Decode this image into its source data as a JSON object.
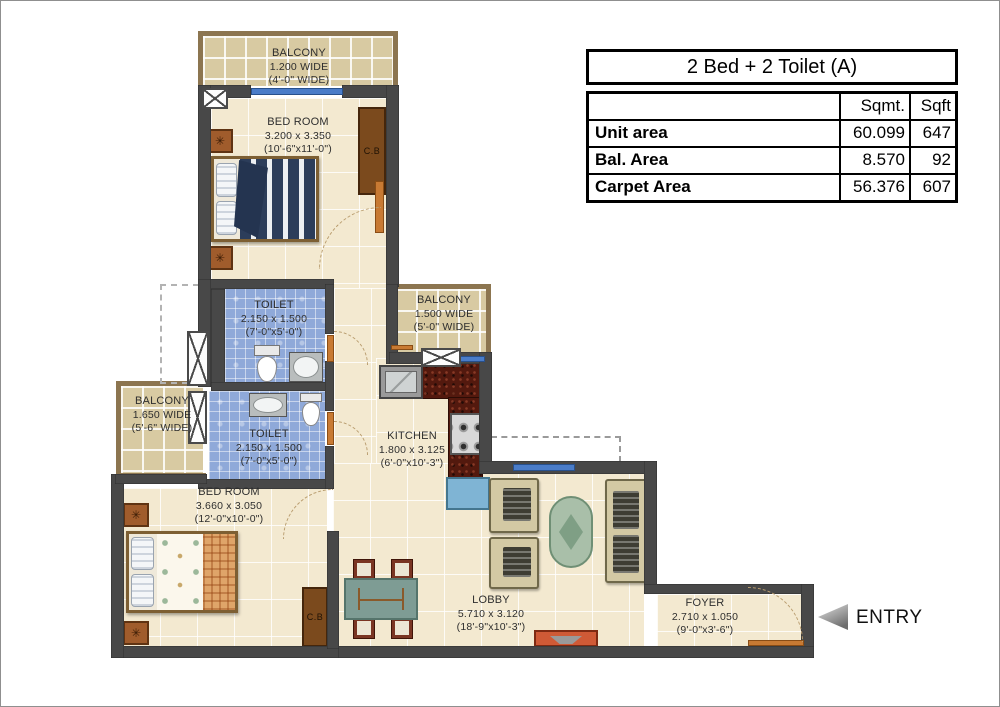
{
  "table": {
    "title": "2 Bed + 2 Toilet (A)",
    "columns": [
      "",
      "Sqmt.",
      "Sqft"
    ],
    "rows": [
      {
        "label": "Unit area",
        "sqmt": "60.099",
        "sqft": "647"
      },
      {
        "label": "Bal. Area",
        "sqmt": "8.570",
        "sqft": "92"
      },
      {
        "label": "Carpet Area",
        "sqmt": "56.376",
        "sqft": "607"
      }
    ]
  },
  "rooms": {
    "balcony_top": {
      "name": "BALCONY",
      "dim_m": "1.200 WIDE",
      "dim_ft": "(4'-0\" WIDE)"
    },
    "bedroom_top": {
      "name": "BED ROOM",
      "dim_m": "3.200 x 3.350",
      "dim_ft": "(10'-6\"x11'-0\")"
    },
    "toilet_top": {
      "name": "TOILET",
      "dim_m": "2.150 x 1.500",
      "dim_ft": "(7'-0\"x5'-0\")"
    },
    "balcony_right": {
      "name": "BALCONY",
      "dim_m": "1.500 WIDE",
      "dim_ft": "(5'-0\" WIDE)"
    },
    "balcony_left": {
      "name": "BALCONY",
      "dim_m": "1.650 WIDE",
      "dim_ft": "(5'-6\" WIDE)"
    },
    "toilet_bottom": {
      "name": "TOILET",
      "dim_m": "2.150 x 1.500",
      "dim_ft": "(7'-0\"x5'-0\")"
    },
    "kitchen": {
      "name": "KITCHEN",
      "dim_m": "1.800 x 3.125",
      "dim_ft": "(6'-0\"x10'-3\")"
    },
    "bedroom_bottom": {
      "name": "BED ROOM",
      "dim_m": "3.660 x 3.050",
      "dim_ft": "(12'-0\"x10'-0\")"
    },
    "lobby": {
      "name": "LOBBY",
      "dim_m": "5.710 x 3.120",
      "dim_ft": "(18'-9\"x10'-3\")"
    },
    "foyer": {
      "name": "FOYER",
      "dim_m": "2.710 x 1.050",
      "dim_ft": "(9'-0\"x3'-6\")"
    }
  },
  "labels": {
    "entry": "ENTRY",
    "cupboard": "C.B",
    "nightstand_glyph": "✳"
  },
  "colors": {
    "wall": "#484848",
    "floor": "#f3e9d0",
    "balcony_tile": "#d8caa2",
    "toilet_tile": "#8fa9d9",
    "door": "#c87a33",
    "window": "#4a7cc8",
    "kitchen_counter": "#53190e",
    "table_border": "#000000"
  }
}
